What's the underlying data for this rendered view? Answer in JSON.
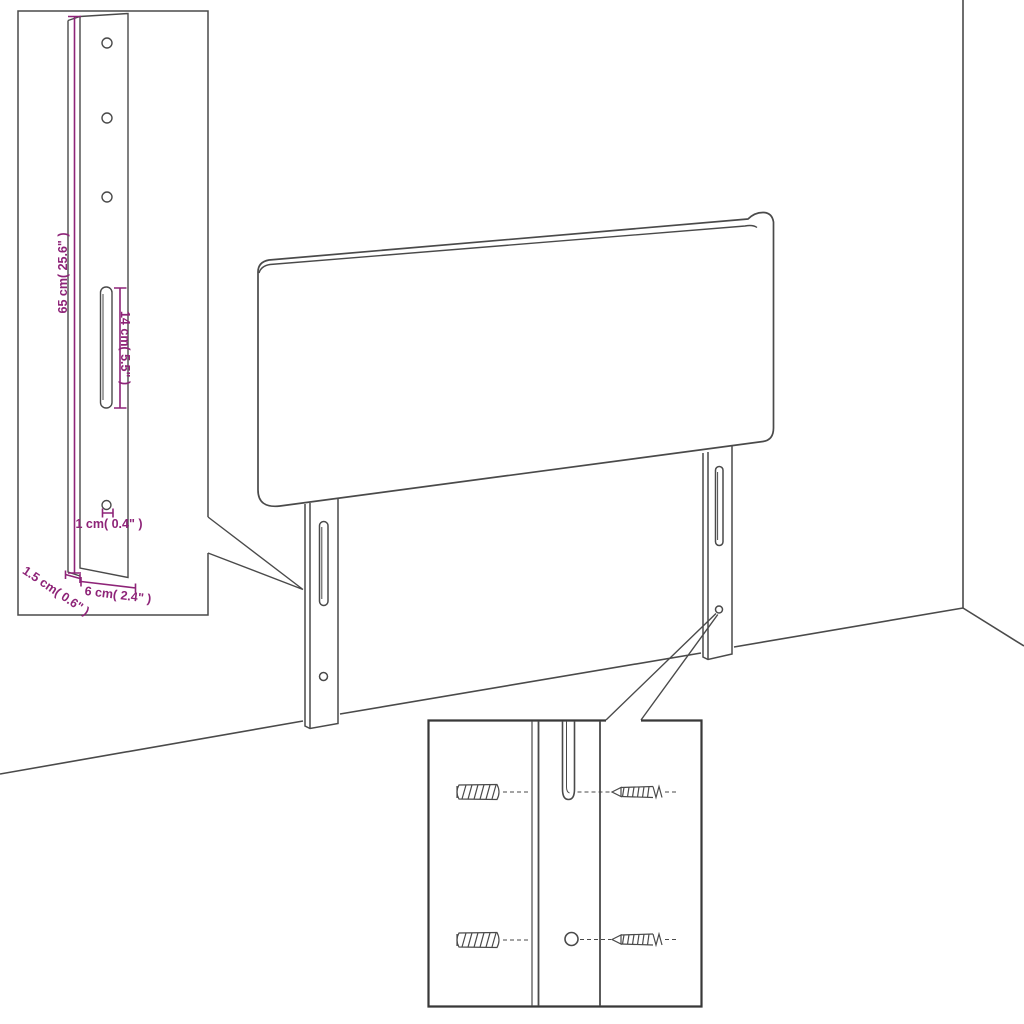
{
  "diagram": {
    "type": "headboard-assembly-diagram",
    "colors": {
      "background": "#ffffff",
      "line": "#4a4a4a",
      "dimension": "#8e2478"
    },
    "labels": {
      "bracket_height": "65 cm( 25.6\" )",
      "slot_length": "14 cm( 5.5\" )",
      "hole_offset": "1 cm( 0.4\" )",
      "edge_thickness": "1.5 cm( 0.6\" )",
      "bracket_width": "6 cm( 2.4\" )"
    }
  }
}
